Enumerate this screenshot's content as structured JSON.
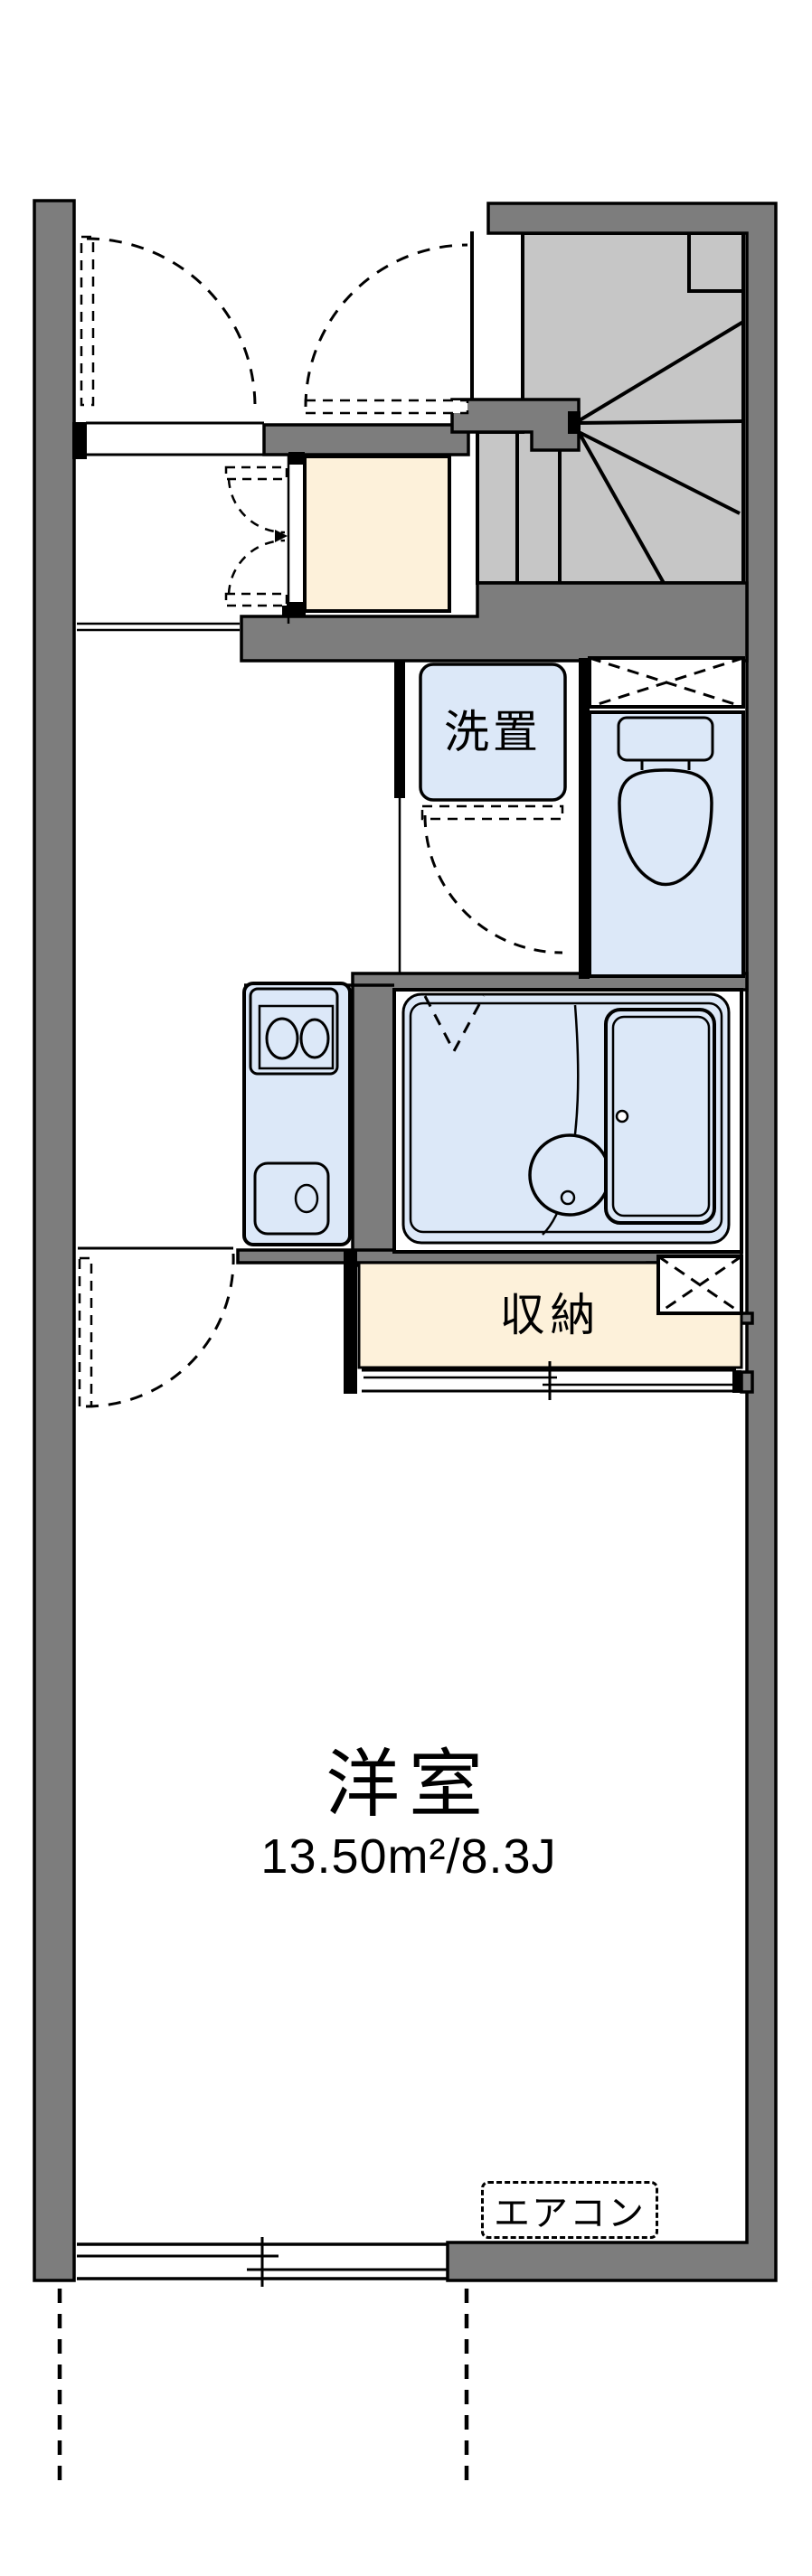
{
  "title": "apartment-floor-plan",
  "rooms": {
    "laundry_label": "洗置",
    "storage_label": "収納",
    "main_room_label": "洋室",
    "main_room_area": "13.50m²/8.3J",
    "aircon_label": "エアコン"
  },
  "colors": {
    "wall_gray": "#7d7d7d",
    "stairs_gray": "#c6c6c6",
    "fixture_blue": "#dce8f8",
    "storage_beige": "#fdf1da",
    "line_black": "#000000",
    "background": "#ffffff"
  }
}
